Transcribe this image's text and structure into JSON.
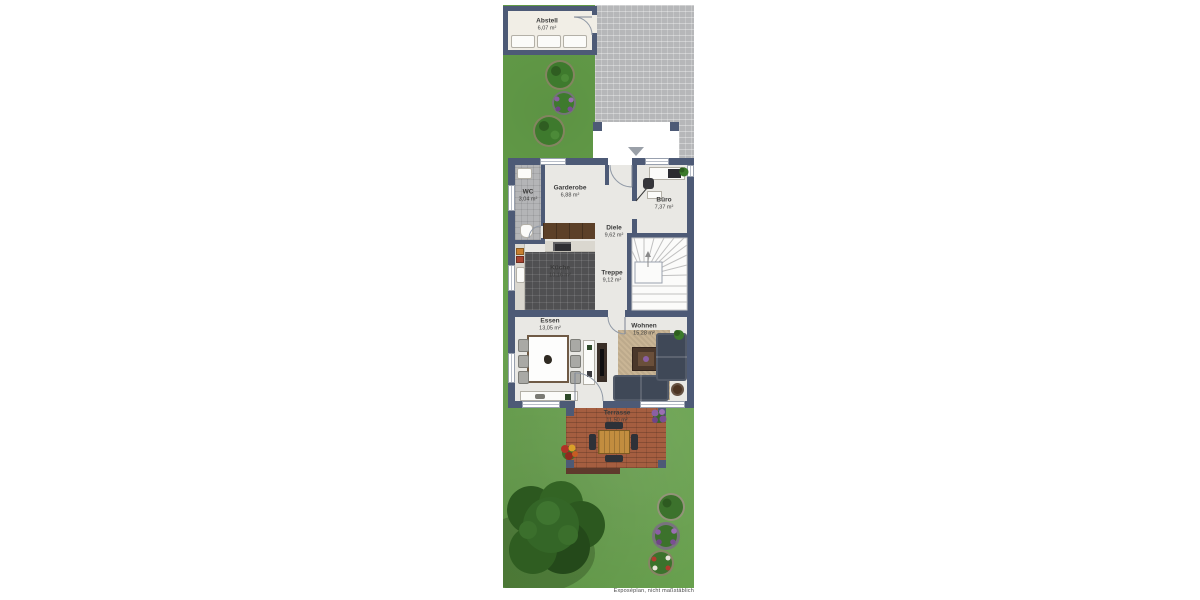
{
  "caption": "Exposéplan, nicht maßstäblich",
  "rooms": [
    {
      "name": "Abstell",
      "area": "6,07 m²"
    },
    {
      "name": "WC",
      "area": "3,04 m²"
    },
    {
      "name": "Garderobe",
      "area": "6,88 m²"
    },
    {
      "name": "Büro",
      "area": "7,37 m²"
    },
    {
      "name": "Diele",
      "area": "9,62 m²"
    },
    {
      "name": "Küche",
      "area": "10,16 m²"
    },
    {
      "name": "Treppe",
      "area": "9,12 m²"
    },
    {
      "name": "Essen",
      "area": "13,05 m²"
    },
    {
      "name": "Wohnen",
      "area": "15,28 m²"
    },
    {
      "name": "Terrasse",
      "area": "11,50 m²"
    }
  ],
  "markers": {
    "entrance": "down-arrow"
  },
  "palette": {
    "wall": "#4d5a76",
    "interior_floor": "#e9e8e4",
    "grass": "#67a34b",
    "driveway": "#b6b7b9",
    "terrace_brick": "#a55e40",
    "kitchen_tile": "#505052",
    "rug": "#c9b595",
    "sofa": "#3f4857",
    "wood": "#c28d3f"
  }
}
